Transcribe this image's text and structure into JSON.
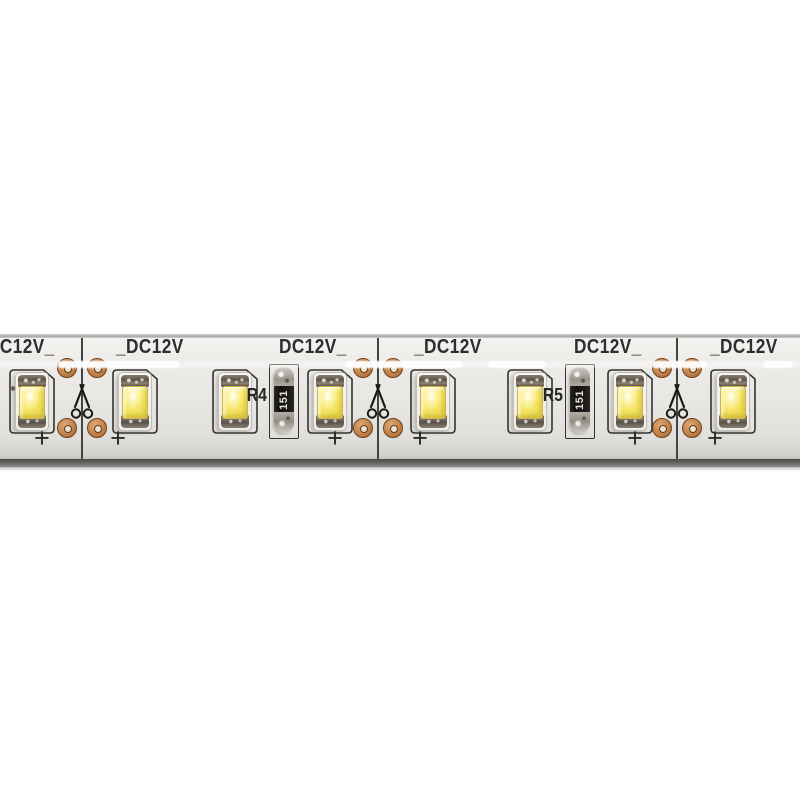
{
  "scene": {
    "background_color": "#ffffff"
  },
  "strip": {
    "voltage_text": "DC12V",
    "plus_symbol": "+",
    "colors": {
      "strip_body": "#e8e6e3",
      "bottom_edge": "#5f5d5a",
      "copper_pad": "#c98b54",
      "led_phosphor_yellow": "#f3e45c",
      "silkscreen_text": "#2d2d2b"
    },
    "voltage_labels": [
      {
        "text": "DC12V_",
        "x": -13
      },
      {
        "text": "_DC12V",
        "x": 116
      },
      {
        "text": "DC12V_",
        "x": 279
      },
      {
        "text": "_DC12V",
        "x": 414
      },
      {
        "text": "DC12V_",
        "x": 574
      },
      {
        "text": "_DC12V",
        "x": 710
      }
    ],
    "leds": [
      {
        "x": 32,
        "speck": true
      },
      {
        "x": 135
      },
      {
        "x": 235
      },
      {
        "x": 330
      },
      {
        "x": 433
      },
      {
        "x": 530
      },
      {
        "x": 630
      },
      {
        "x": 733
      }
    ],
    "resistors": [
      {
        "x": 284,
        "designator": "R4",
        "value": "151"
      },
      {
        "x": 580,
        "designator": "R5",
        "value": "151"
      }
    ],
    "cut_points": [
      {
        "x": 82
      },
      {
        "x": 378
      },
      {
        "x": 677
      }
    ],
    "plus_marks": [
      {
        "x": 42
      },
      {
        "x": 118
      },
      {
        "x": 335
      },
      {
        "x": 420
      },
      {
        "x": 635
      },
      {
        "x": 715
      }
    ],
    "gloss_dashes": [
      {
        "x": 58,
        "w": 122
      },
      {
        "x": 345,
        "w": 118
      },
      {
        "x": 488,
        "w": 58
      },
      {
        "x": 652,
        "w": 55
      },
      {
        "x": 763,
        "w": 30
      }
    ]
  }
}
